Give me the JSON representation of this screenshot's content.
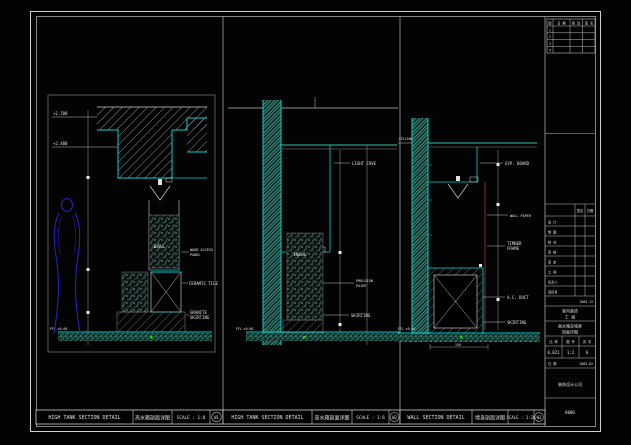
{
  "bars": [
    {
      "title": "HIGH TANK SECTION DETAIL",
      "cn": "高水箱剖面详图",
      "scale": "SCALE : 1:8",
      "ref": "W1"
    },
    {
      "title": "HIGH TANK SECTION DETAIL",
      "cn": "高水箱剖面详图",
      "scale": "SCALE : 1:8",
      "ref": "W2"
    },
    {
      "title": "WALL SECTION DETAIL",
      "cn": "墙身剖面详图",
      "scale": "SCALE : 1:10",
      "ref": "W3"
    }
  ],
  "p1": {
    "lvl1": "+2.700",
    "lvl2": "+2.400",
    "callout1": "WOOD ACCESS",
    "callout1b": "PANEL",
    "y1": "CERAMIC TILE",
    "y2": "GRANITE",
    "y2b": "SKIRTING",
    "m1": "INSUL",
    "ffl": "FFL ±0.00"
  },
  "p2": {
    "y1": "LIGHT COVE",
    "w1": "EMULSION",
    "w1b": "PAINT",
    "y2": "SKIRTING",
    "m1": "INSUL",
    "ffl": "FFL ±0.00"
  },
  "p3": {
    "l1": "CEILING",
    "y1": "GYP. BOARD",
    "w1": "WALL PAPER",
    "y2": "TIMBER",
    "y2b": "FRAME",
    "y3": "A.C. DUCT",
    "y4": "SKIRTING",
    "ffl": "FFL ±0.00",
    "dim": "150"
  },
  "titleblock": {
    "rev_h1": "版",
    "rev_h2": "日 期",
    "rev_h3": "修 改",
    "rev_h4": "签 名",
    "rev_r1": "1",
    "rev_r2": "2",
    "rev_r3": "3",
    "rev_r4": "4",
    "sign": "签名",
    "date": "日期",
    "rows": [
      "设 计",
      "制 图",
      "校 对",
      "审 核",
      "审 定",
      "工 种",
      "负责人",
      "项目号"
    ],
    "note": "2005.12",
    "project1": "室内装饰",
    "project2": "工 程",
    "dwg1": "高水箱及墙身",
    "dwg2": "剖面详图",
    "c1l": "比 例",
    "c1v": "6.021",
    "c2l": "图 号",
    "c2v": "1:2",
    "c3l": "页 次",
    "c3v": "6",
    "d1l": "日 期",
    "d1v": "2005.02",
    "company": "装饰设计公司",
    "serial": "0000"
  },
  "colors": {
    "cyan": "#00d2d2",
    "teal": "#2cc4a8",
    "yellow": "#d6d22e",
    "magenta": "#c455c4",
    "blue": "#2a24c8",
    "line": "#cfcfcf",
    "gray": "#9a9a9a",
    "red": "#7a3030",
    "green": "#39c41f"
  }
}
